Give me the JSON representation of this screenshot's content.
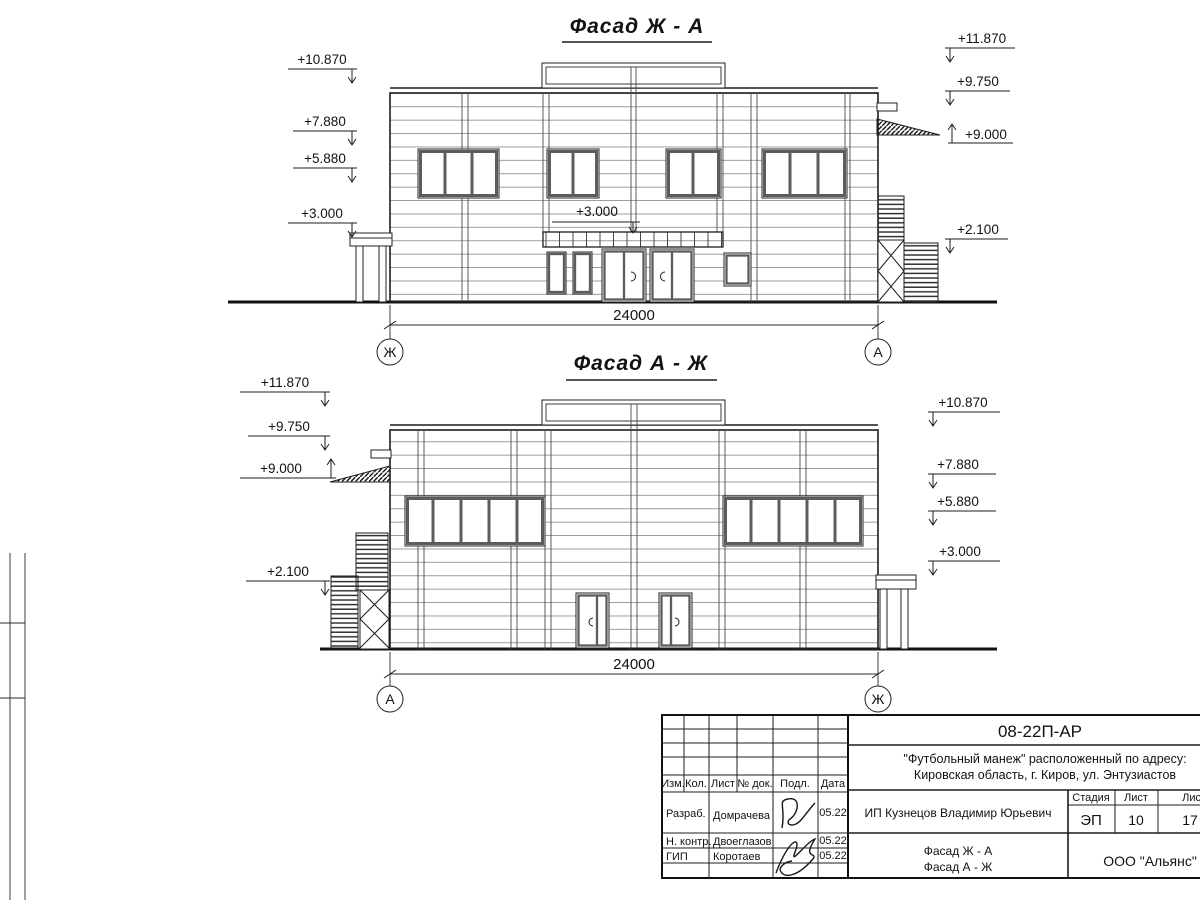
{
  "facades": [
    {
      "title": "Фасад Ж - А",
      "dimension": "24000",
      "axis_left": "Ж",
      "axis_right": "А",
      "marks_left": [
        "+10.870",
        "+7.880",
        "+5.880",
        "+3.000"
      ],
      "marks_right": [
        "+11.870",
        "+9.750",
        "+9.000",
        "+2.100"
      ],
      "mark_center": "+3.000"
    },
    {
      "title": "Фасад А - Ж",
      "dimension": "24000",
      "axis_left": "А",
      "axis_right": "Ж",
      "marks_left": [
        "+11.870",
        "+9.750",
        "+9.000",
        "+2.100"
      ],
      "marks_right": [
        "+10.870",
        "+7.880",
        "+5.880",
        "+3.000"
      ]
    }
  ],
  "title_block": {
    "doc_number": "08-22П-АР",
    "project_address_line1": "\"Футбольный манеж\" расположенный по адресу:",
    "project_address_line2": "Кировская область, г. Киров, ул. Энтузиастов",
    "client": "ИП Кузнецов Владимир Юрьевич",
    "header_cols": {
      "izm": "Изм.",
      "kol": "Кол.",
      "list": "Лист",
      "doc": "№ док.",
      "sign": "Подл.",
      "date": "Дата"
    },
    "signers": [
      {
        "role": "Разраб.",
        "name": "Домрачева",
        "date": "05.22"
      },
      {
        "role": "Н. контр.",
        "name": "Двоеглазов",
        "date": "05.22"
      },
      {
        "role": "ГИП",
        "name": "Коротаев",
        "date": "05.22"
      }
    ],
    "stage_label": "Стадия",
    "sheet_label": "Лист",
    "sheets_label": "Листов",
    "stage": "ЭП",
    "sheet_num": "10",
    "sheets_total": "17",
    "content_line1": "Фасад Ж - А",
    "content_line2": "Фасад А - Ж",
    "company": "ООО \"Альянс\""
  },
  "colors": {
    "ink": "#1d1d1d",
    "paper": "#ffffff"
  }
}
